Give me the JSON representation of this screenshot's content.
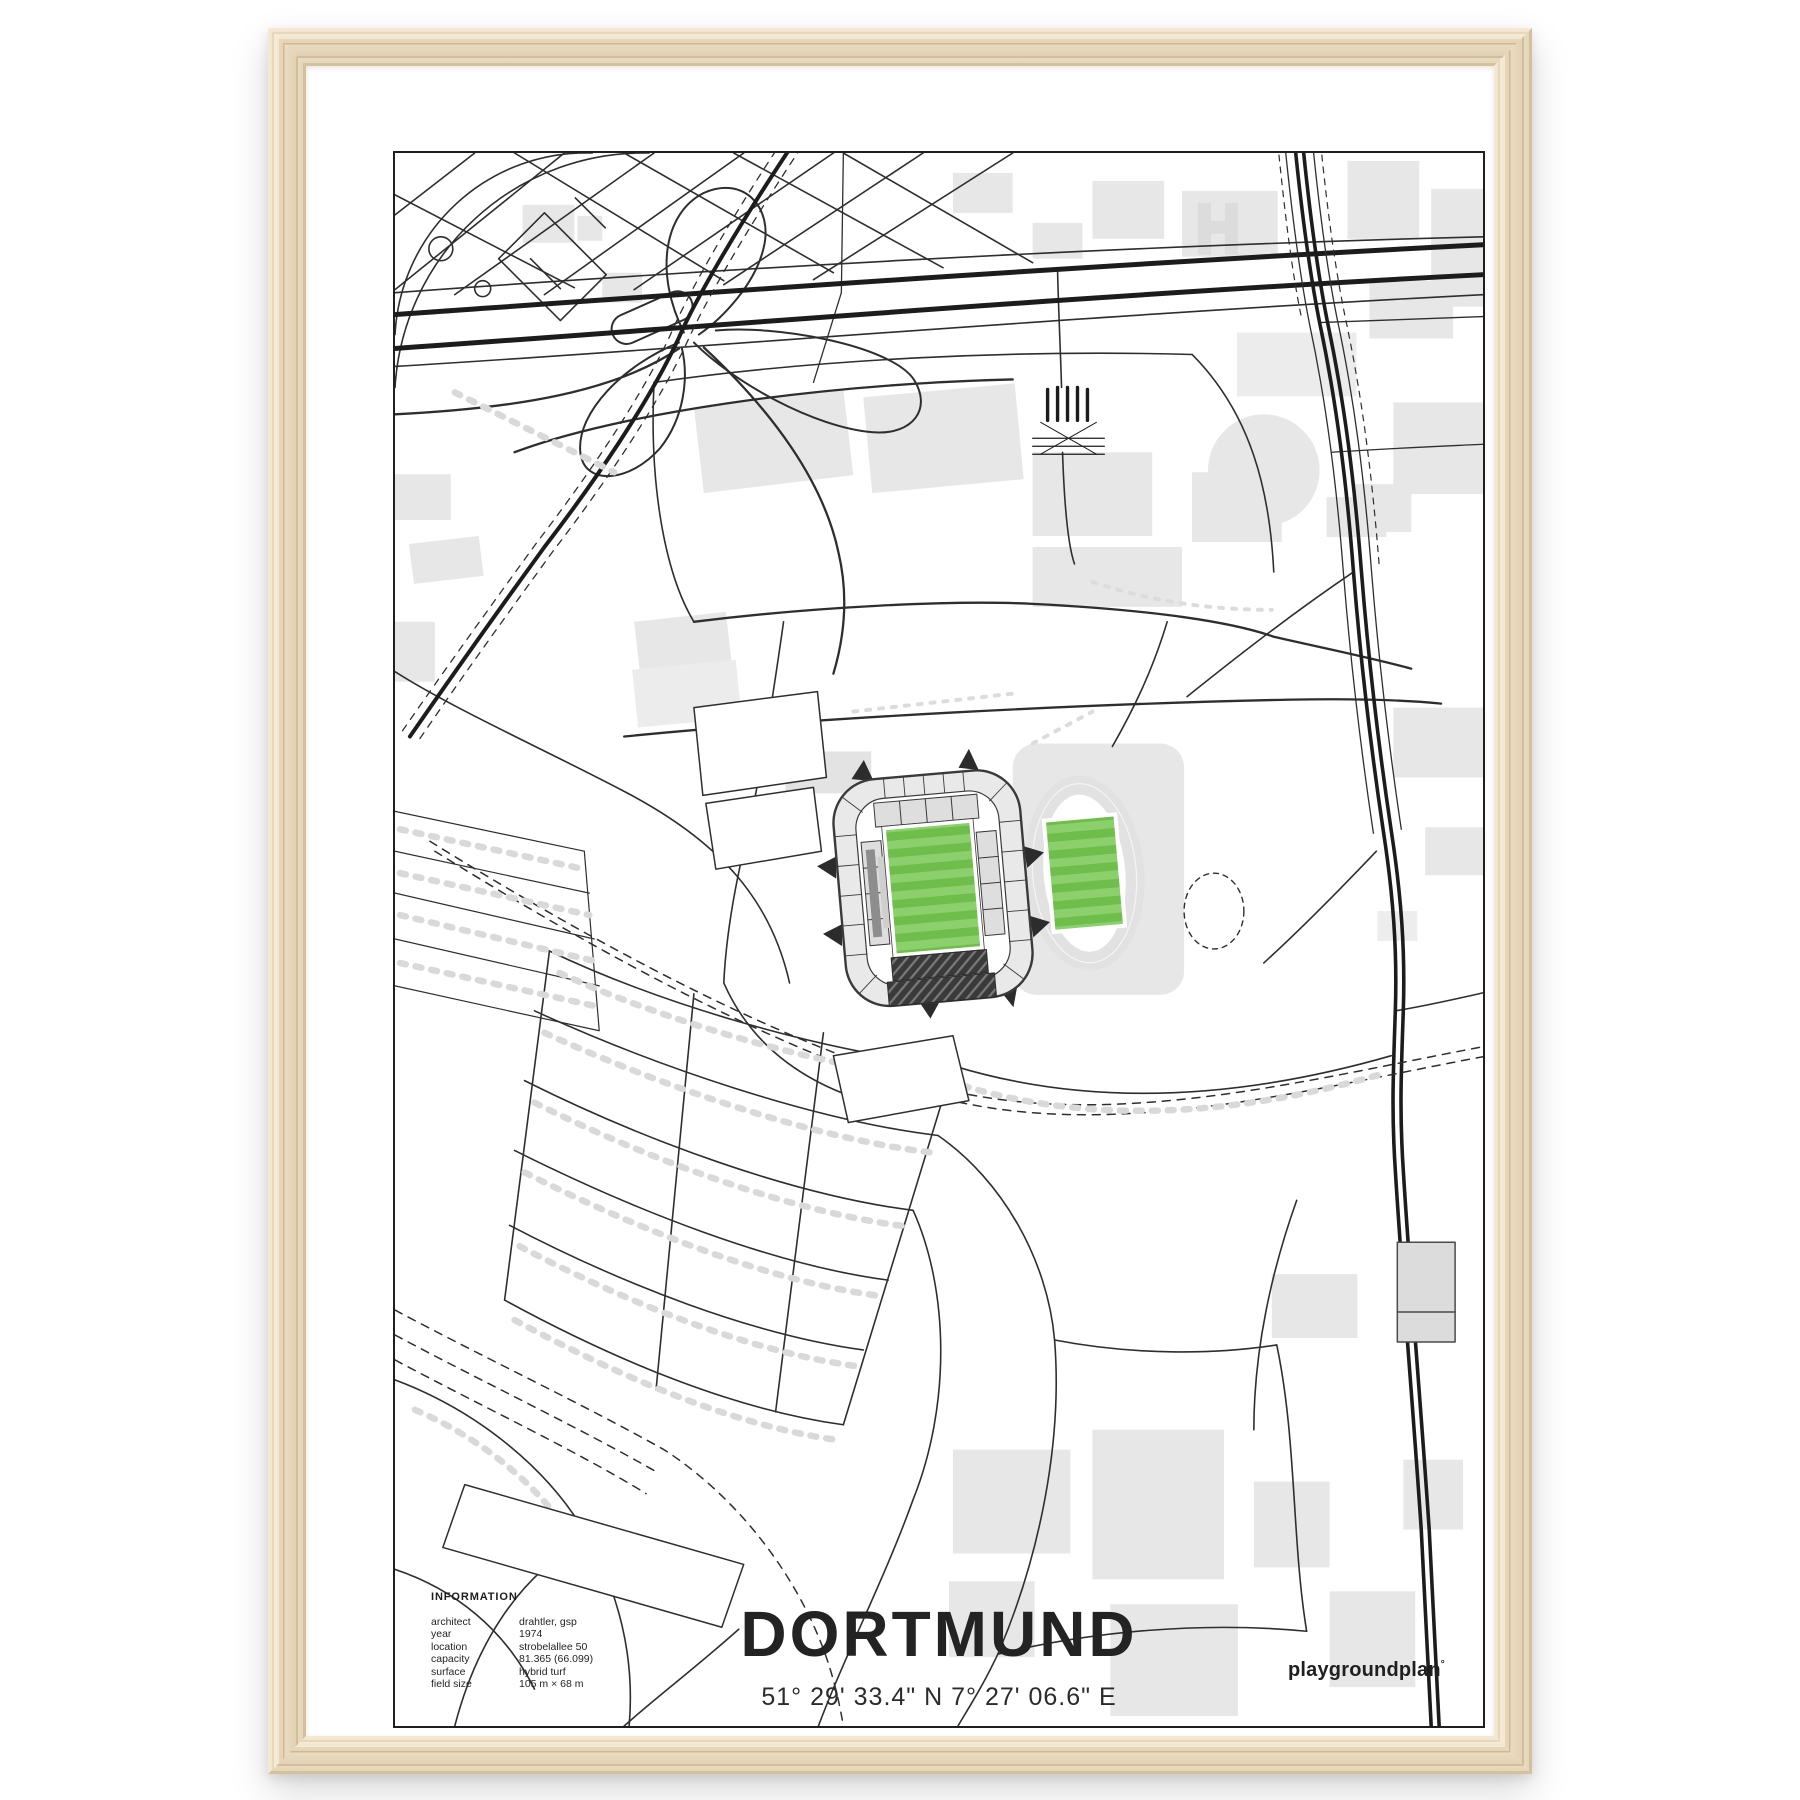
{
  "poster": {
    "title": "DORTMUND",
    "coordinates": "51° 29' 33.4\" N  7° 27' 06.6\" E",
    "brand": "playgroundplan",
    "brand_mark": "°",
    "info": {
      "heading": "INFORMATION",
      "rows": [
        {
          "label": "architect",
          "value": "drahtler, gsp"
        },
        {
          "label": "year",
          "value": "1974"
        },
        {
          "label": "location",
          "value": "strobelallee 50"
        },
        {
          "label": "capacity",
          "value": "81.365 (66.099)"
        },
        {
          "label": "surface",
          "value": "hybrid turf"
        },
        {
          "label": "field size",
          "value": "105 m × 68 m"
        }
      ]
    }
  },
  "map": {
    "subject": "Signal Iduna Park and Stadion Rote Erde area, Dortmund",
    "features": [
      "stadium",
      "athletics-track",
      "highway-b1",
      "rail-corridor",
      "residential-streets",
      "exhibition-halls"
    ]
  },
  "colors": {
    "pitch_green_dark": "#6fbd4b",
    "pitch_green_light": "#8bd06d",
    "building_gray": "#e7e7e7",
    "line_black": "#2e2e2e",
    "frame_wood": "#e9d6b2",
    "matte_white": "#ffffff"
  }
}
